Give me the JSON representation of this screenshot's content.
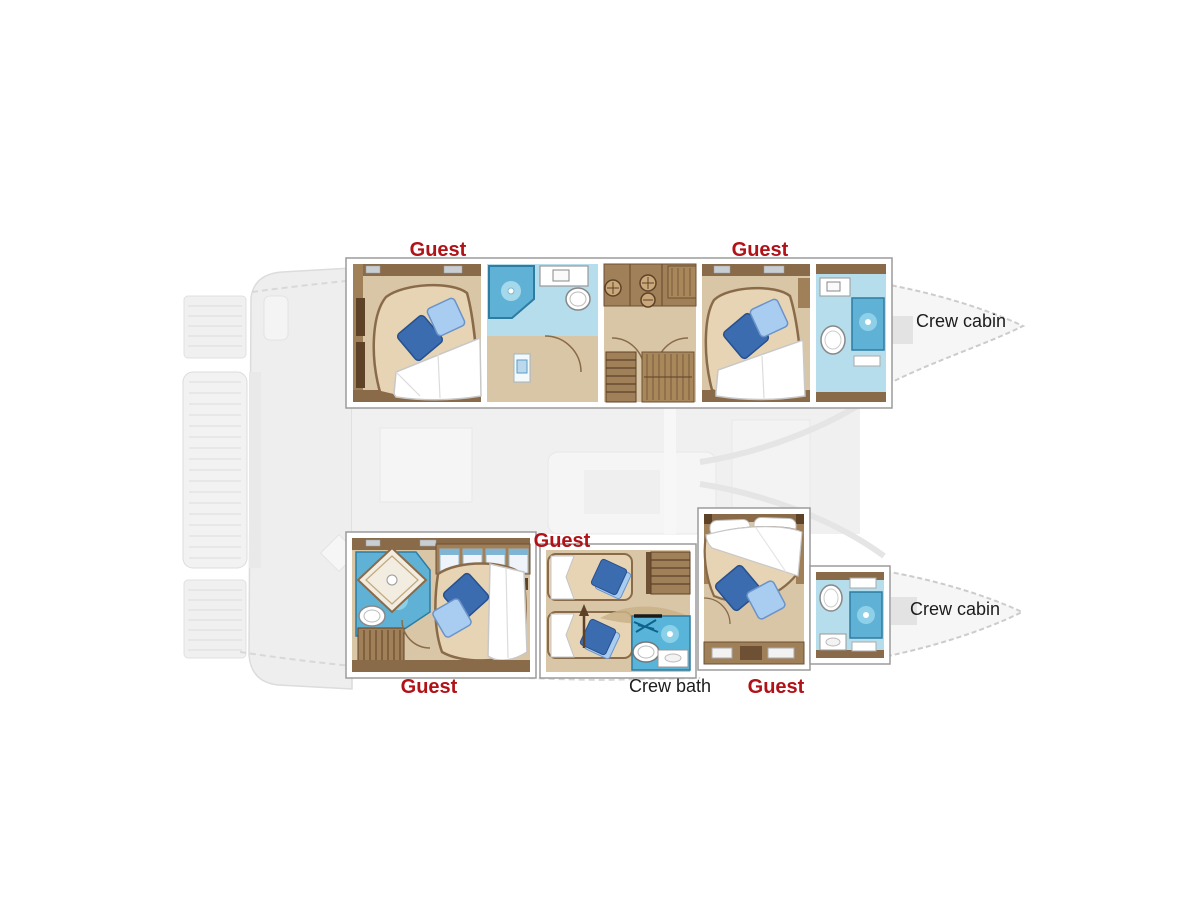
{
  "plan": {
    "labels": {
      "guest_top_left": "Guest",
      "guest_top_right": "Guest",
      "crew_cabin_top": "Crew cabin",
      "guest_middle": "Guest",
      "crew_cabin_bottom": "Crew cabin",
      "guest_bottom_left": "Guest",
      "crew_bath": "Crew bath",
      "guest_bottom_right": "Guest"
    }
  },
  "colors": {
    "guest_label": "#b01218",
    "crew_label": "#1c1c1c",
    "wall_stroke": "#9b9b9b",
    "floor_tan": "#d9c6a6",
    "wood_dark": "#8a6b49",
    "wood_mid": "#a08059",
    "mattress": "#e6d4b4",
    "bath_floor": "#b5ddec",
    "shower_blue": "#5fb2d6",
    "crew_bath_blue": "#58b4d8",
    "pillow_dark": "#3c6cb0",
    "pillow_light": "#a9cdf0",
    "faded_fill": "#eeeeee",
    "faded_stroke": "#dcdcdc"
  }
}
